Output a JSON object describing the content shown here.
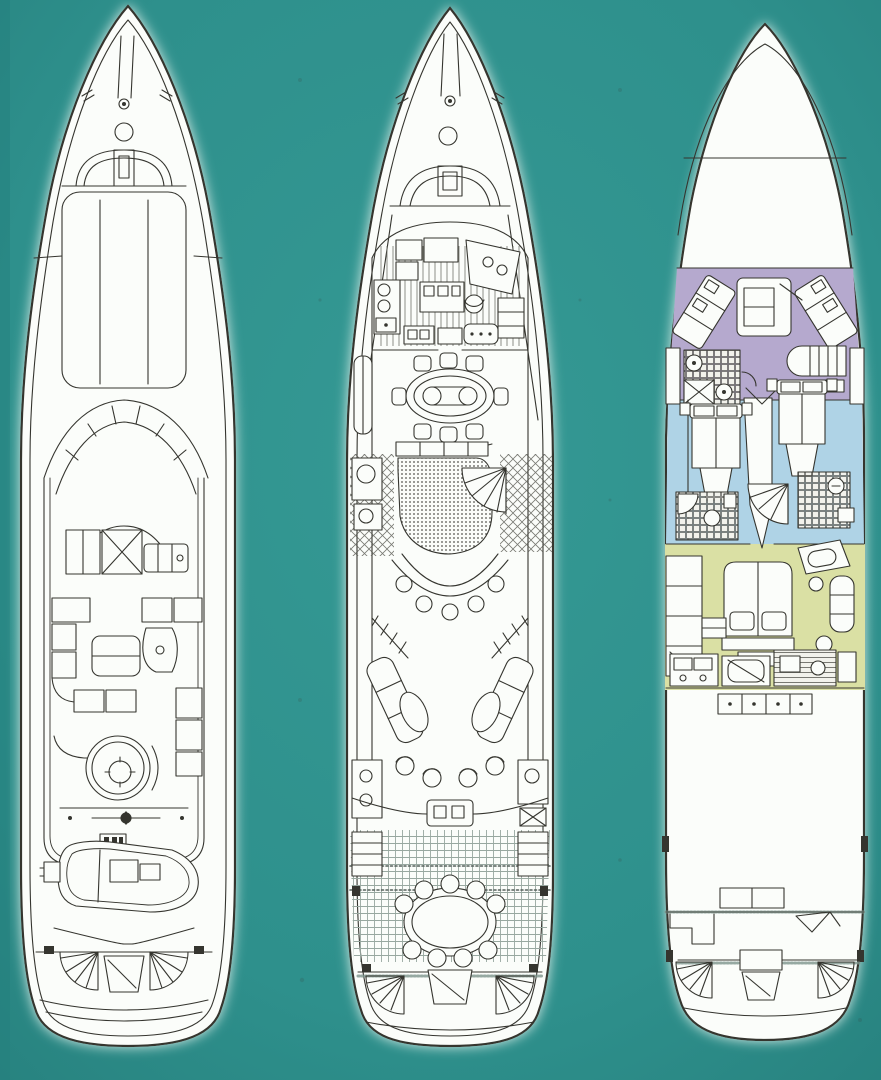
{
  "window": {
    "width": 881,
    "height": 1080
  },
  "colors": {
    "background": "#2E908C",
    "background_light": "#359994",
    "background_shade": "#27817E",
    "hull_white": "#FBFDFA",
    "hull_glow": "#DFF0EA",
    "linework": "#35352F",
    "crew_zone_purple": "#B5A9CE",
    "guest_zone_blue": "#AFD3E6",
    "owner_zone_green": "#DAE0A4"
  },
  "figure": {
    "type": "yacht-deck-plan-diagram",
    "plans": [
      {
        "id": "sun-deck-plan",
        "position": "left"
      },
      {
        "id": "main-deck-plan",
        "position": "center"
      },
      {
        "id": "lower-deck-plan",
        "position": "right",
        "zones": [
          {
            "id": "crew-zone",
            "color_key": "crew_zone_purple"
          },
          {
            "id": "guest-zone",
            "color_key": "guest_zone_blue"
          },
          {
            "id": "owner-zone",
            "color_key": "owner_zone_green"
          }
        ]
      }
    ]
  }
}
